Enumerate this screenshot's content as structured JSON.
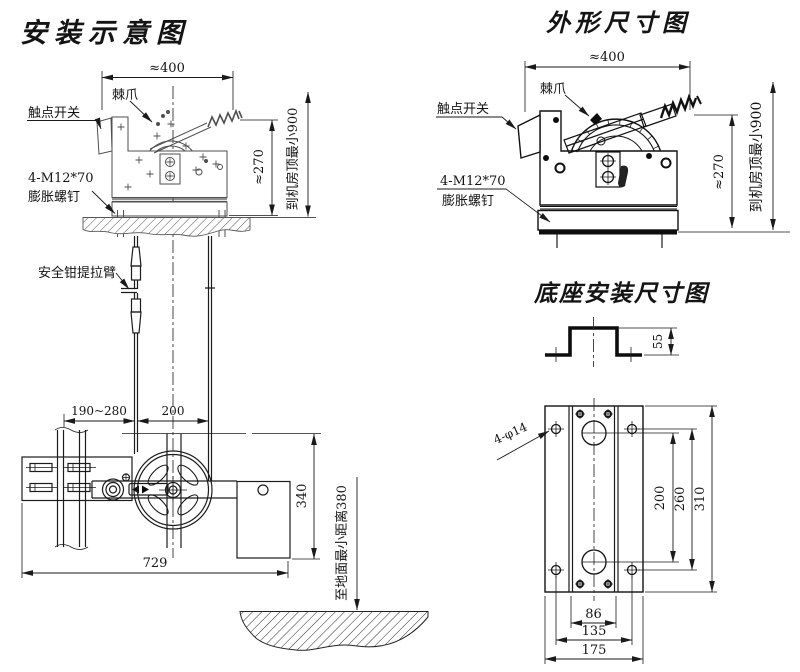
{
  "drawing": {
    "installation": {
      "title": "安装示意图",
      "labels": {
        "pawl": "棘爪",
        "contact_switch": "触点开关",
        "bolt_spec": "4-M12*70",
        "bolt_name": "膨胀螺钉",
        "safety_gear_arm": "安全钳提拉臂"
      },
      "dims": {
        "top_width": "≈400",
        "body_height": "≈270",
        "to_machine_room_ceiling": "到机房顶最小900",
        "rail_to_rope": "190~280",
        "rope_span": "200",
        "tension_height": "340",
        "overall_width": "729",
        "min_to_floor": "至地面最小距离380"
      }
    },
    "outline": {
      "title": "外形尺寸图",
      "labels": {
        "pawl": "棘爪",
        "contact_switch": "触点开关",
        "bolt_spec": "4-M12*70",
        "bolt_name": "膨胀螺钉"
      },
      "dims": {
        "top_width": "≈400",
        "body_height": "≈270",
        "to_machine_room_ceiling": "到机房顶最小900"
      }
    },
    "base": {
      "title": "底座安装尺寸图",
      "labels": {
        "mounting_holes": "4-φ14"
      },
      "dims": {
        "channel_height": "55",
        "hole_pitch_v1": "200",
        "hole_pitch_v2": "260",
        "plate_length": "310",
        "channel_width": "86",
        "hole_pitch_h": "135",
        "plate_width": "175"
      }
    }
  }
}
